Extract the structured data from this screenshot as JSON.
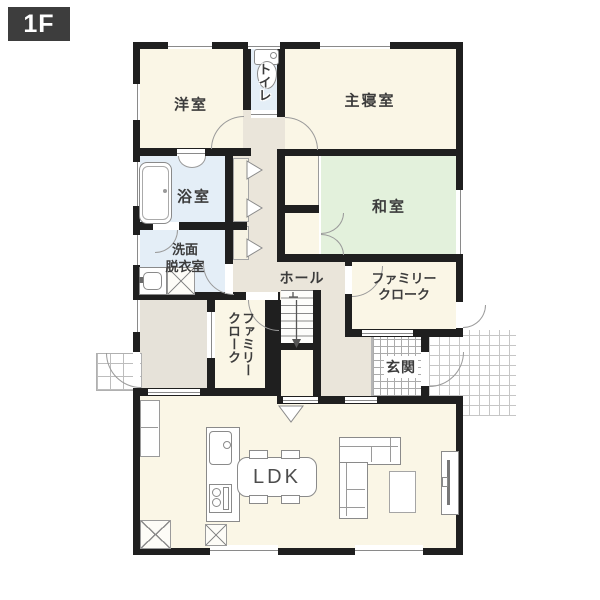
{
  "floor_badge": "1F",
  "colors": {
    "wall": "#1f1f1f",
    "cream": "#faf6e6",
    "tatami": "#e3f1dc",
    "wet": "#e4eef7",
    "hall": "#eae5da",
    "gray_room": "#e6e2d9",
    "badge_bg": "#3d3d3d",
    "badge_text": "#ffffff",
    "fixture_line": "#8a8a8a",
    "text": "#3c3c3c"
  },
  "rooms": {
    "western_room": {
      "label": "洋室"
    },
    "toilet": {
      "label": "トイレ"
    },
    "master_bedroom": {
      "label": "主寝室"
    },
    "bathroom": {
      "label": "浴室"
    },
    "japanese_room": {
      "label": "和室"
    },
    "washroom": {
      "line1": "洗面",
      "line2": "脱衣室"
    },
    "hall": {
      "label": "ホール"
    },
    "family_closet_west": {
      "line1": "ファミリー",
      "line2": "クローク"
    },
    "family_closet_east": {
      "line1": "ファミリー",
      "line2": "クローク"
    },
    "entrance": {
      "label": "玄関"
    },
    "ldk": {
      "label": "LDK"
    }
  }
}
